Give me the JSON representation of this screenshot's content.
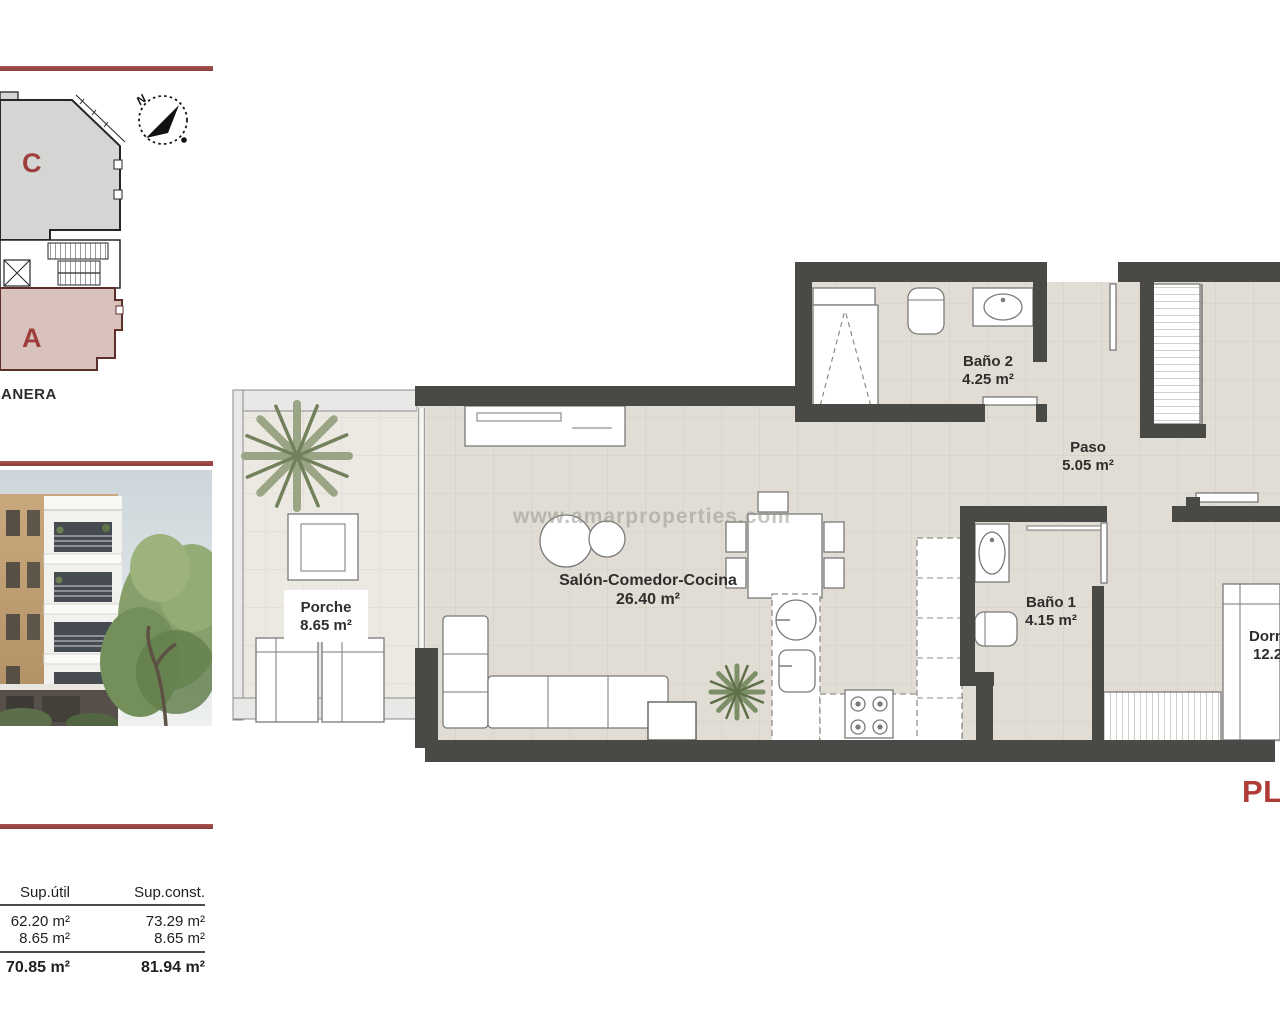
{
  "colors": {
    "accent_red": "#9c4744",
    "plan_title_red": "#ae3b36",
    "wall_gray": "#494946",
    "floor_beige": "#e1dcd4",
    "block_c_fill": "#d5d5d3",
    "block_a_fill": "#d9c2bc"
  },
  "sidebar": {
    "site_plan": {
      "block_c_label": "C",
      "block_a_label": "A",
      "street_label": "ANERA"
    },
    "compass": {
      "north_label": "N"
    },
    "areas_table": {
      "col1_header": "Sup.útil",
      "col2_header": "Sup.const.",
      "rows": [
        {
          "util": "62.20 m²",
          "const": "73.29 m²"
        },
        {
          "util": "8.65 m²",
          "const": "8.65 m²"
        }
      ],
      "total": {
        "util": "70.85 m²",
        "const": "81.94 m²"
      }
    }
  },
  "plan": {
    "watermark": "www.amarproperties.com",
    "plan_title": "PLA",
    "rooms": [
      {
        "name": "Porche",
        "area": "8.65 m²"
      },
      {
        "name": "Salón-Comedor-Cocina",
        "area": "26.40 m²"
      },
      {
        "name": "Baño 2",
        "area": "4.25 m²"
      },
      {
        "name": "Paso",
        "area": "5.05 m²"
      },
      {
        "name": "Baño 1",
        "area": "4.15 m²"
      },
      {
        "name": "Dorm",
        "area": "12.2"
      }
    ]
  }
}
